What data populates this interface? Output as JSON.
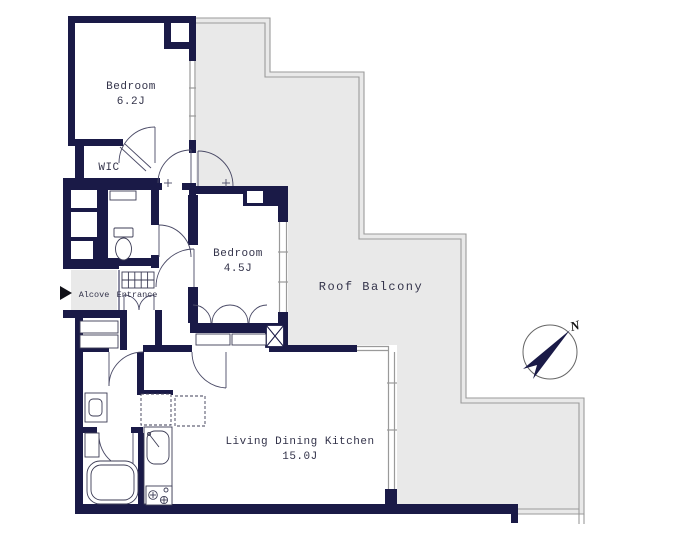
{
  "plan": {
    "rooms": {
      "bedroom1": {
        "name": "Bedroom",
        "size": "6.2J"
      },
      "wic": {
        "name": "WIC"
      },
      "bedroom2": {
        "name": "Bedroom",
        "size": "4.5J"
      },
      "roof_balcony": {
        "name": "Roof Balcony"
      },
      "alcove": {
        "name": "Alcove"
      },
      "entrance": {
        "name": "Entrance"
      },
      "ldk": {
        "name": "Living Dining Kitchen",
        "size": "15.0J"
      }
    },
    "compass": {
      "north_label": "N"
    },
    "colors": {
      "wall": "#1a1a47",
      "balcony_fill": "#e9e9e9",
      "railing": "#9a9a9a",
      "line": "#4a4a66",
      "text": "#33334a"
    }
  }
}
